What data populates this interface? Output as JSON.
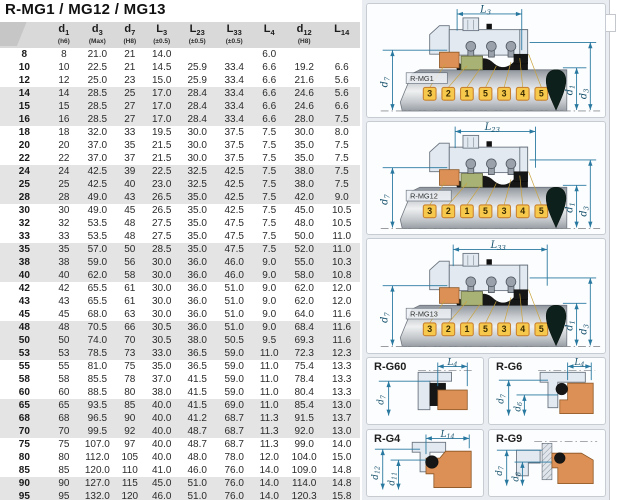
{
  "title": "R-MG1 / MG12 / MG13",
  "table": {
    "columns": [
      {
        "base": "",
        "sub": "",
        "tol": ""
      },
      {
        "base": "d",
        "sub": "1",
        "tol": "(h6)"
      },
      {
        "base": "d",
        "sub": "3",
        "tol": "(Max)"
      },
      {
        "base": "d",
        "sub": "7",
        "tol": "(H8)"
      },
      {
        "base": "L",
        "sub": "3",
        "tol": "(±0.5)"
      },
      {
        "base": "L",
        "sub": "23",
        "tol": "(±0.5)"
      },
      {
        "base": "L",
        "sub": "33",
        "tol": "(±0.5)"
      },
      {
        "base": "L",
        "sub": "4",
        "tol": ""
      },
      {
        "base": "d",
        "sub": "12",
        "tol": "(H8)"
      },
      {
        "base": "L",
        "sub": "14",
        "tol": ""
      }
    ],
    "rows": [
      [
        "8",
        "8",
        "21.0",
        "21",
        "14.0",
        "",
        "",
        "6.0",
        "",
        ""
      ],
      [
        "10",
        "10",
        "22.5",
        "21",
        "14.5",
        "25.9",
        "33.4",
        "6.6",
        "19.2",
        "6.6"
      ],
      [
        "12",
        "12",
        "25.0",
        "23",
        "15.0",
        "25.9",
        "33.4",
        "6.6",
        "21.6",
        "5.6"
      ],
      [
        "14",
        "14",
        "28.5",
        "25",
        "17.0",
        "28.4",
        "33.4",
        "6.6",
        "24.6",
        "5.6"
      ],
      [
        "15",
        "15",
        "28.5",
        "27",
        "17.0",
        "28.4",
        "33.4",
        "6.6",
        "24.6",
        "6.6"
      ],
      [
        "16",
        "16",
        "28.5",
        "27",
        "17.0",
        "28.4",
        "33.4",
        "6.6",
        "28.0",
        "7.5"
      ],
      [
        "18",
        "18",
        "32.0",
        "33",
        "19.5",
        "30.0",
        "37.5",
        "7.5",
        "30.0",
        "8.0"
      ],
      [
        "20",
        "20",
        "37.0",
        "35",
        "21.5",
        "30.0",
        "37.5",
        "7.5",
        "35.0",
        "7.5"
      ],
      [
        "22",
        "22",
        "37.0",
        "37",
        "21.5",
        "30.0",
        "37.5",
        "7.5",
        "35.0",
        "7.5"
      ],
      [
        "24",
        "24",
        "42.5",
        "39",
        "22.5",
        "32.5",
        "42.5",
        "7.5",
        "38.0",
        "7.5"
      ],
      [
        "25",
        "25",
        "42.5",
        "40",
        "23.0",
        "32.5",
        "42.5",
        "7.5",
        "38.0",
        "7.5"
      ],
      [
        "28",
        "28",
        "49.0",
        "43",
        "26.5",
        "35.0",
        "42.5",
        "7.5",
        "42.0",
        "9.0"
      ],
      [
        "30",
        "30",
        "49.0",
        "45",
        "26.5",
        "35.0",
        "42.5",
        "7.5",
        "45.0",
        "10.5"
      ],
      [
        "32",
        "32",
        "53.5",
        "48",
        "27.5",
        "35.0",
        "47.5",
        "7.5",
        "48.0",
        "10.5"
      ],
      [
        "33",
        "33",
        "53.5",
        "48",
        "27.5",
        "35.0",
        "47.5",
        "7.5",
        "50.0",
        "11.0"
      ],
      [
        "35",
        "35",
        "57.0",
        "50",
        "28.5",
        "35.0",
        "47.5",
        "7.5",
        "52.0",
        "11.0"
      ],
      [
        "38",
        "38",
        "59.0",
        "56",
        "30.0",
        "36.0",
        "46.0",
        "9.0",
        "55.0",
        "10.3"
      ],
      [
        "40",
        "40",
        "62.0",
        "58",
        "30.0",
        "36.0",
        "46.0",
        "9.0",
        "58.0",
        "10.8"
      ],
      [
        "42",
        "42",
        "65.5",
        "61",
        "30.0",
        "36.0",
        "51.0",
        "9.0",
        "62.0",
        "12.0"
      ],
      [
        "43",
        "43",
        "65.5",
        "61",
        "30.0",
        "36.0",
        "51.0",
        "9.0",
        "62.0",
        "12.0"
      ],
      [
        "45",
        "45",
        "68.0",
        "63",
        "30.0",
        "36.0",
        "51.0",
        "9.0",
        "64.0",
        "11.6"
      ],
      [
        "48",
        "48",
        "70.5",
        "66",
        "30.5",
        "36.0",
        "51.0",
        "9.0",
        "68.4",
        "11.6"
      ],
      [
        "50",
        "50",
        "74.0",
        "70",
        "30.5",
        "38.0",
        "50.5",
        "9.5",
        "69.3",
        "11.6"
      ],
      [
        "53",
        "53",
        "78.5",
        "73",
        "33.0",
        "36.5",
        "59.0",
        "11.0",
        "72.3",
        "12.3"
      ],
      [
        "55",
        "55",
        "81.0",
        "75",
        "35.0",
        "36.5",
        "59.0",
        "11.0",
        "75.4",
        "13.3"
      ],
      [
        "58",
        "58",
        "85.5",
        "78",
        "37.0",
        "41.5",
        "59.0",
        "11.0",
        "78.4",
        "13.3"
      ],
      [
        "60",
        "60",
        "88.5",
        "80",
        "38.0",
        "41.5",
        "59.0",
        "11.0",
        "80.4",
        "13.3"
      ],
      [
        "65",
        "65",
        "93.5",
        "85",
        "40.0",
        "41.5",
        "69.0",
        "11.0",
        "85.4",
        "13.0"
      ],
      [
        "68",
        "68",
        "96.5",
        "90",
        "40.0",
        "41.2",
        "68.7",
        "11.3",
        "91.5",
        "13.7"
      ],
      [
        "70",
        "70",
        "99.5",
        "92",
        "40.0",
        "48.7",
        "68.7",
        "11.3",
        "92.0",
        "13.0"
      ],
      [
        "75",
        "75",
        "107.0",
        "97",
        "40.0",
        "48.7",
        "68.7",
        "11.3",
        "99.0",
        "14.0"
      ],
      [
        "80",
        "80",
        "112.0",
        "105",
        "40.0",
        "48.0",
        "78.0",
        "12.0",
        "104.0",
        "15.0"
      ],
      [
        "85",
        "85",
        "120.0",
        "110",
        "41.0",
        "46.0",
        "76.0",
        "14.0",
        "109.0",
        "14.8"
      ],
      [
        "90",
        "90",
        "127.0",
        "115",
        "45.0",
        "51.0",
        "76.0",
        "14.0",
        "114.0",
        "14.8"
      ],
      [
        "95",
        "95",
        "132.0",
        "120",
        "46.0",
        "51.0",
        "76.0",
        "14.0",
        "120.3",
        "15.8"
      ],
      [
        "100",
        "100",
        "137.0",
        "125",
        "47.0",
        "51.0",
        "76.0",
        "14.0",
        "123.3",
        "15.8"
      ]
    ]
  },
  "diagrams": {
    "callout_numbers": [
      "3",
      "2",
      "1",
      "5",
      "3",
      "4",
      "5"
    ],
    "side_dims": {
      "d7": {
        "base": "d",
        "sub": "7"
      },
      "d1": {
        "base": "d",
        "sub": "1"
      },
      "d3": {
        "base": "d",
        "sub": "3"
      }
    },
    "mg1": {
      "name": "R-MG1",
      "top": {
        "base": "L",
        "sub": "3"
      }
    },
    "mg12": {
      "name": "R-MG12",
      "top": {
        "base": "L",
        "sub": "23"
      }
    },
    "mg13": {
      "name": "R-MG13",
      "top": {
        "base": "L",
        "sub": "33"
      }
    },
    "seats": [
      {
        "name": "R-G60",
        "top": {
          "base": "L",
          "sub": "4"
        },
        "left": [
          {
            "base": "d",
            "sub": "7"
          }
        ]
      },
      {
        "name": "R-G6",
        "top": {
          "base": "L",
          "sub": "4"
        },
        "left": [
          {
            "base": "d",
            "sub": "7"
          },
          {
            "base": "d",
            "sub": "6"
          }
        ]
      },
      {
        "name": "R-G4",
        "top": {
          "base": "L",
          "sub": "14"
        },
        "left": [
          {
            "base": "d",
            "sub": "12"
          },
          {
            "base": "d",
            "sub": "11"
          }
        ]
      },
      {
        "name": "R-G9",
        "left": [
          {
            "base": "d",
            "sub": "7"
          },
          {
            "base": "d",
            "sub": "8"
          }
        ]
      }
    ]
  },
  "colors": {
    "dimension_line": "#2878a0",
    "callout_fill": "#f6c84c",
    "callout_border": "#c9822f",
    "seat_ring": "#dc9055",
    "seal_face": "#a8b274",
    "elastomer": "#1a1a1a",
    "diagram_background": "#e9edf2",
    "header_band": "#d9d9d9",
    "row_band": "#e4e4e4"
  }
}
